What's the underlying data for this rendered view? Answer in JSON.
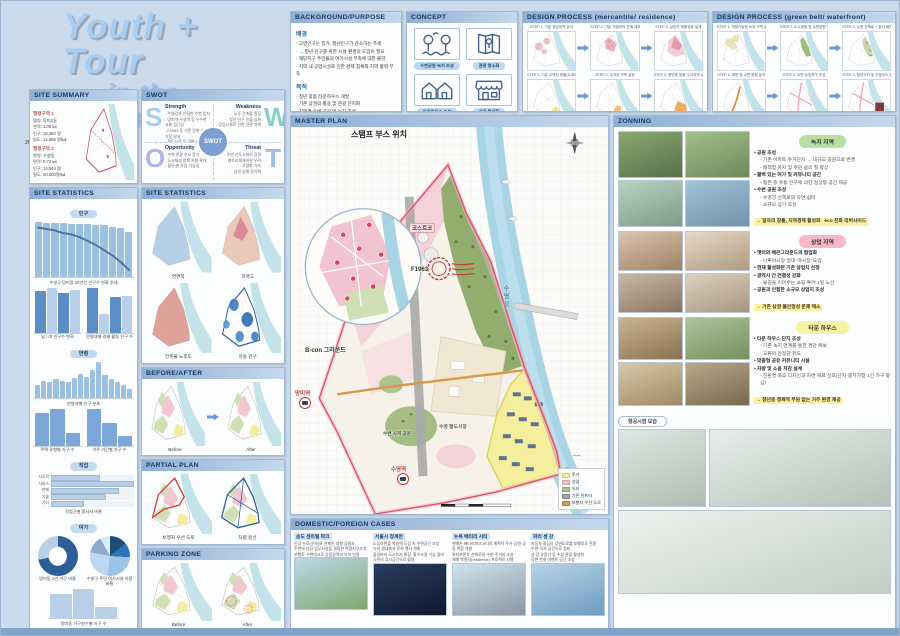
{
  "title": {
    "line1": "Youth + Tour",
    "line2": "in the Waterfront",
    "authors": "20222531 윤지운 20222556 이승연"
  },
  "site_summary": {
    "header": "SITE SUMMARY",
    "district1": {
      "title": "행정구역 1",
      "lines": [
        "명칭: 망미2동",
        "면적: 1.05 ㎢",
        "인구: 13,260 명",
        "밀도: 12,666 명/㎢"
      ]
    },
    "district2": {
      "title": "행정구역 2",
      "lines": [
        "명칭: 수영동",
        "면적: 0.72 ㎢",
        "인구: 14,544 명",
        "밀도: 20,000명/㎢"
      ]
    }
  },
  "swot": {
    "header": "SWOT",
    "center": "SWOT",
    "s": {
      "letter": "S",
      "title": "Strength",
      "lines": [
        "수영강과 인접한 수변 입지",
        "망미역·수영역 등 우수한 교통 접근성",
        "F1963 등 기존 문화·상업 거점 보유",
        "팔도시장 등 전통 상권 존재"
      ]
    },
    "w": {
      "letter": "W",
      "title": "Weakness",
      "lines": [
        "노후 건축물 밀집",
        "청년 인구 유출 심화",
        "공업시설로 인한 경관 저해"
      ]
    },
    "o": {
      "letter": "O",
      "title": "Opportunity",
      "lines": [
        "수변 관광 수요 증가",
        "도시재생 정책 지원 확대",
        "젊은 층 유입 가능성"
      ]
    },
    "t": {
      "letter": "T",
      "title": "Threat",
      "lines": [
        "주변 신도시와의 경쟁",
        "젠트리피케이션 우려",
        "고령화 가속",
        "상권 침체 장기화"
      ]
    }
  },
  "stats1": {
    "header": "SITE STATISTICS",
    "pill1": "인구",
    "pill2": "연령",
    "pill3": "직업",
    "pill4": "여가",
    "trend": {
      "type": "bars",
      "values": [
        96,
        95,
        95,
        94,
        93,
        93,
        92,
        91,
        90,
        88,
        86,
        78
      ],
      "line": [
        92,
        91,
        90,
        88,
        87,
        85,
        82,
        79,
        75,
        71,
        66,
        60
      ],
      "caption": "수영구 망미동 10년간 인구수 변화 추세"
    },
    "g1": {
      "type": "bars",
      "values": [
        82,
        88,
        78,
        84
      ],
      "colors": [
        "#5b8ec4",
        "#b8d0e8",
        "#5b8ec4",
        "#b8d0e8"
      ],
      "caption": "남 / 여 인구수 변화"
    },
    "g2": {
      "type": "bars",
      "values": [
        88,
        38,
        70,
        72
      ],
      "colors": [
        "#5b8ec4",
        "#b8d0e8",
        "#5b8ec4",
        "#b8d0e8"
      ],
      "caption": "연령대별 경제 활동 인구 수"
    },
    "age": {
      "type": "bars",
      "values": [
        28,
        35,
        33,
        40,
        36,
        34,
        42,
        50,
        44,
        58,
        75,
        48,
        40,
        33,
        26,
        18
      ],
      "caption": "연령대별 인구 분포"
    },
    "h1": {
      "type": "bars",
      "values": [
        78,
        88,
        30
      ],
      "colors": [
        "#7da7d8"
      ],
      "caption": "주택 유형별 가구 수"
    },
    "h2": {
      "type": "bars",
      "values": [
        82,
        50,
        22
      ],
      "colors": [
        "#7da7d8"
      ],
      "caption": "거주 기간별 가구 수"
    },
    "jobs": {
      "type": "hbars",
      "values": [
        52,
        88,
        72,
        58,
        35
      ],
      "labels": [
        "사무직",
        "서비스",
        "판매",
        "기술",
        "기타"
      ],
      "caption": "직업군별 종사자 비율"
    },
    "donut": {
      "type": "donut",
      "slices": [
        [
          "#2e5e96",
          72
        ],
        [
          "#b9cfe8",
          28
        ]
      ],
      "caption": "망미동 1인 가구 비율"
    },
    "pie": {
      "type": "pie",
      "slices": [
        [
          "#1f4e79",
          14
        ],
        [
          "#2e75b6",
          12
        ],
        [
          "#9dc3e6",
          26
        ],
        [
          "#bdd7ee",
          26
        ],
        [
          "#8eaacc",
          14
        ],
        [
          "#deebf7",
          8
        ]
      ],
      "caption": "수영구 주민 여가시설 이용 비율"
    },
    "b3": {
      "type": "bars",
      "values": [
        72,
        88,
        35
      ],
      "colors": [
        "#b9cfe8"
      ],
      "caption": "망미동 가구원수별 가구 수"
    }
  },
  "stats2": {
    "header": "SITE STATISTICS",
    "maps": [
      "연면적",
      "지목도",
      "건축물 노후도",
      "유동 인구"
    ]
  },
  "before_after": {
    "header": "BEFORE/AFTER",
    "left": "Before",
    "right": "After"
  },
  "partial_plan": {
    "header": "PARTIAL PLAN",
    "left": "보행자 우선 도로",
    "right": "차량 동선"
  },
  "parking": {
    "header": "PARKING ZONE",
    "left": "Before",
    "right": "After"
  },
  "background": {
    "header": "BACKGROUND/PURPOSE",
    "s1_title": "배경",
    "s1": [
      "고령인구는 증가, 청년인구가 감소하는 추세",
      "→ 청년 인구를 위한 시설·환경의 도입이 필요",
      "해당지구 주민들의 여가시설 부족에 대한 불만",
      "지역 내 공업시설로 인한 경제 침체와 지역 활력 부족"
    ],
    "s2_title": "목적",
    "s2": [
      "청년 맞춤 타운하우스 개발",
      "기존 상권의 활용 및 관광 단지화",
      "친환경 수변 공원 및 녹지 조성",
      "지역 경제 활성화 도모"
    ]
  },
  "concept": {
    "header": "CONCEPT",
    "items": [
      "수변공원·녹지 조성",
      "관광 명소화",
      "타운하우스 조성",
      "상권 활성화"
    ]
  },
  "process1": {
    "header": "DESIGN PROCESS (mercantile/ residence)",
    "steps": [
      "STEP 1. 기존 상업지역 분석",
      "STEP 2. 기존 거점과의 연계 계획",
      "STEP 3. 상업지 재활성화 설계",
      "STEP 1. 기존 주택지 현황(노후도) 분석",
      "STEP 2. 주거지 구역 설정",
      "STEP 3. 청년층 맞춤 주거지역 설계"
    ]
  },
  "process2": {
    "header": "DESIGN PROCESS (green belt/ waterfront)",
    "steps": [
      "STEP 1. 재생가능한 녹지 구역 분석",
      "STEP 2. 도시공원 및 수변공원 노선",
      "STEP 3. 수변 산책로 + 쉼터 배치",
      "STEP 1. 제방 및 수변 현황 분석",
      "STEP 2. 수변 상업지구 조성",
      "STEP 3. 청년거리 및 관광코스 완성"
    ]
  },
  "master": {
    "header": "MASTER PLAN",
    "inset_title": "스탬프 부스 위치",
    "labels": {
      "costco": "코스트코",
      "f1963": "F1963",
      "river": "수영강",
      "bcon": "B-con 그라운드",
      "station1": "망미역",
      "station2": "수영역",
      "market": "수영 팔도시장",
      "park": "수변 사적 공원"
    },
    "legend": [
      {
        "label": "주거",
        "color": "#f3ee9b"
      },
      {
        "label": "상업",
        "color": "#f2c0cb"
      },
      {
        "label": "녹지",
        "color": "#a9bf85"
      },
      {
        "label": "기존 인프라",
        "color": "#a0a0a0"
      },
      {
        "label": "보행자 우선 도로",
        "color": "#cf9b57"
      }
    ]
  },
  "zoning": {
    "header": "ZONNING",
    "aerial": "항공시점 모습",
    "green": {
      "pill": "녹지 지역",
      "photos": [
        [
          "#8aa86f",
          "#55724a"
        ],
        [
          "#a3bf8a",
          "#6d8a5a"
        ],
        [
          "#b9d2c2",
          "#7d9c8a"
        ],
        [
          "#9fc4d8",
          "#6f94ad"
        ]
      ],
      "bullets": [
        {
          "t": "• 공원 조성",
          "s": "b1"
        },
        {
          "t": "- 기존 아파트 주거단지 → 대규모 공원으로 변경",
          "s": "b2"
        },
        {
          "t": "- 쾌적함 유지 및 주민 삶의 질 향상",
          "s": "b2"
        },
        {
          "t": "• 활력 있는 여가 및 커뮤니티 공간",
          "s": "b1"
        },
        {
          "t": "- 젊은 층 유동 인구에 의한 일상형 공간 제공",
          "s": "b2"
        },
        {
          "t": "• 수변 공원 조성",
          "s": "b1"
        },
        {
          "t": "- 수영강 산책로와 자연 쉼터",
          "s": "b2"
        },
        {
          "t": "- 소규모 상가 조성",
          "s": "b2"
        },
        {
          "t": "→ 일자리 창출, 지역경제 활성화",
          "s": "hl"
        },
        {
          "t": "eco 친화 리버사이드",
          "s": "hl"
        }
      ]
    },
    "pink": {
      "pill": "상업 지역",
      "photos": [
        [
          "#d9c4ae",
          "#a08363"
        ],
        [
          "#e6d8c8",
          "#b09a80"
        ],
        [
          "#c9b8a8",
          "#8a7460"
        ],
        [
          "#ddd0c0",
          "#a89680"
        ]
      ],
      "bullets": [
        {
          "t": "• 옛터와 베큰그라운드의 협업화",
          "s": "b1"
        },
        {
          "t": "- 나루야시장 일대 '야시장' 도입",
          "s": "b2"
        },
        {
          "t": "• 현재 활성화된 기존 상업지 선정",
          "s": "b1"
        },
        {
          "t": "• 광역시 간 연결성 강화",
          "s": "b1"
        },
        {
          "t": "- 물길을 이어주는 쇼핑·투어 1일 노선",
          "s": "b2"
        },
        {
          "t": "• 공원과 인접한 소규모 상업지 조성",
          "s": "b1"
        },
        {
          "t": "→ 기존 상권 불안정성 문제 해소",
          "s": "hl"
        }
      ]
    },
    "yellow": {
      "pill": "타운 하우스",
      "photos": [
        [
          "#c9b490",
          "#8a7252"
        ],
        [
          "#aec49a",
          "#74905e"
        ],
        [
          "#d8c8a8",
          "#a08a62"
        ],
        [
          "#b8a888",
          "#7a6a4e"
        ]
      ],
      "bullets": [
        {
          "t": "• 타운 하우스 단지 조성",
          "s": "b1"
        },
        {
          "t": "- 기존 녹지 연계를 통한 경관 확보",
          "s": "b2"
        },
        {
          "t": "- 교류와 안정감 유도",
          "s": "b2"
        },
        {
          "t": "• 맞춤형 공유 커뮤니티 시설",
          "s": "b1"
        },
        {
          "t": "• 차량 및 소음 저감 설계",
          "s": "b1"
        },
        {
          "t": "- 친환경 목조 디자인과 자연 재료 선호(단지·중저가형·1인 가구 중심)",
          "s": "b2"
        },
        {
          "t": "→ 청년층 경제적 부담 없는 거주 환경 제공",
          "s": "hl"
        }
      ]
    },
    "aerial_photos": [
      [
        "#dfe6e2",
        "#aebdb2"
      ],
      [
        "#e8edea",
        "#b5c2b8"
      ],
      [
        "#eef1ee",
        "#c2cfc4"
      ]
    ]
  },
  "cases": {
    "header": "DOMESTIC/FOREIGN CASES",
    "items": [
      {
        "title": "송도 센트럴 파크",
        "lines": [
          "인공 수로(운하)와 연계된 대형 공원과",
          "주변에 상업·업무시설을 결합한 복합지구조성",
          "보행로·수변데크로 상업권역과 녹지 연결"
        ],
        "photo": [
          "#bcd8ea",
          "#7fa86d"
        ]
      },
      {
        "title": "서울시 청계천",
        "lines": [
          "도심하천을 복원해 도심 속 수변공간 조성",
          "녹지 생태축과 문화 행사 개최",
          "물길따라 도시녹지 확장, 홍수조절 기능 겸비",
          "시민의 휴식공간으로 활용"
        ],
        "photo": [
          "#2a3c5e",
          "#0f1a30"
        ]
      },
      {
        "title": "뉴욕 배터리 시티",
        "lines": [
          "맨해튼 배터리파크시티의 계획적 주거·공원·금융 복합 개발",
          "워터프론트 산책로와 수변 주거지 조성",
          "재해 복원력(resilience) 프로젝트 시행"
        ],
        "photo": [
          "#cfe3ef",
          "#8a97a5"
        ]
      },
      {
        "title": "파리 센 강",
        "lines": [
          "자동차 중심의 강변도로를 보행로로 전환",
          "수변·녹지 공간으로 정비",
          "센 강 유람선 등 수상 관광 활성화",
          "강변 문화 이벤트 공간 조성"
        ],
        "photo": [
          "#b7d3e6",
          "#6e9cc0"
        ]
      }
    ]
  }
}
